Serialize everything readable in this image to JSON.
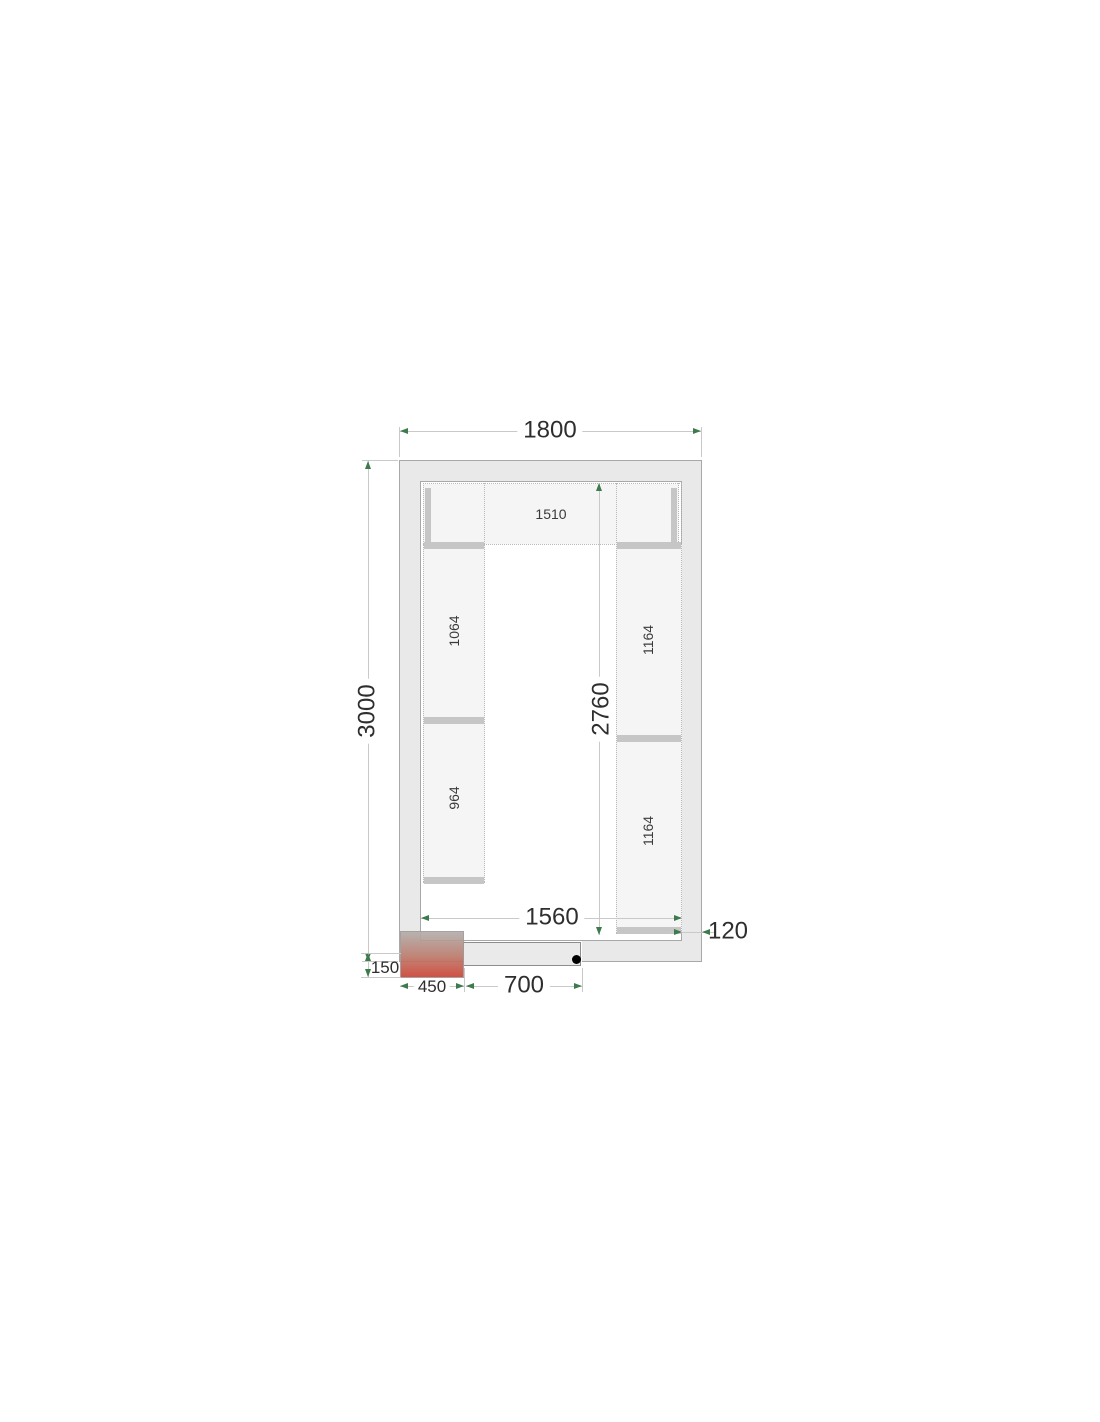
{
  "diagram": {
    "type": "cold-room-floor-plan",
    "dims": {
      "outer_width": "1800",
      "outer_depth": "3000",
      "inner_width": "1560",
      "inner_depth": "2760",
      "wall_thickness": "120",
      "door_width": "700",
      "unit_width": "450",
      "unit_protrusion": "150"
    },
    "shelves": {
      "top": "1510",
      "left_upper": "1064",
      "left_lower": "964",
      "right_upper": "1164",
      "right_lower": "1164"
    },
    "colors": {
      "arrow_green": "#3d7a4c",
      "wall_fill": "#e9e9e9",
      "wall_line": "#a8a8a8",
      "shelf_fill": "#f5f5f5",
      "shelf_bar": "#c6c6c6",
      "dim_line": "#c9c9c9",
      "dot_line": "#b8b8b8",
      "unit_gray": "#b3aeab",
      "unit_red": "#cc4335",
      "hinge": "#000000",
      "text": "#2e2e2e"
    }
  }
}
